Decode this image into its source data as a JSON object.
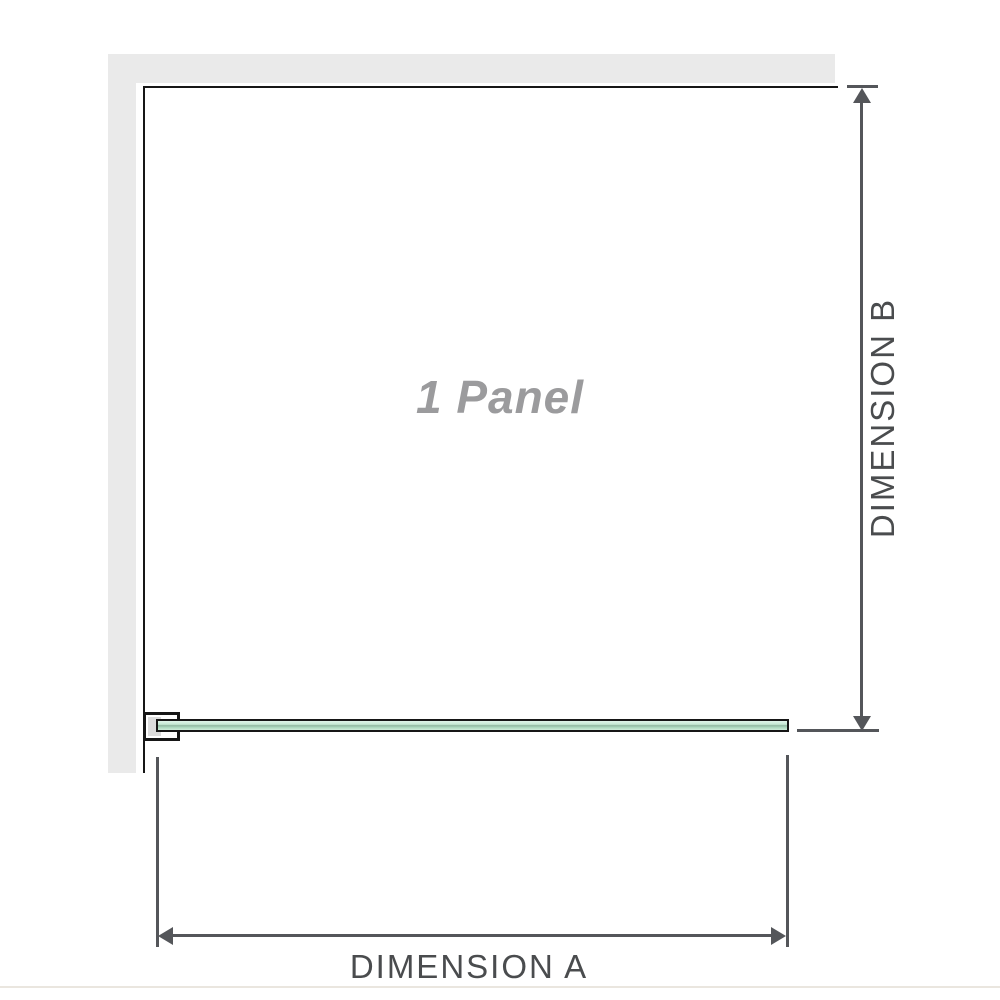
{
  "diagram": {
    "panel_label": "1 Panel",
    "dimension_a_label": "DIMENSION A",
    "dimension_b_label": "DIMENSION B"
  },
  "colors": {
    "wall_gray": "#eaeaea",
    "outline_black": "#161616",
    "dimension_line": "#54565a",
    "dimension_text": "#4a4c4e",
    "panel_label_gray": "#9b9b9d",
    "glass_green_light": "#c4e8d3",
    "glass_green_dark": "#8fb49f",
    "bracket_pad_gray": "#dcdcdc",
    "baseline": "#eae6df"
  }
}
